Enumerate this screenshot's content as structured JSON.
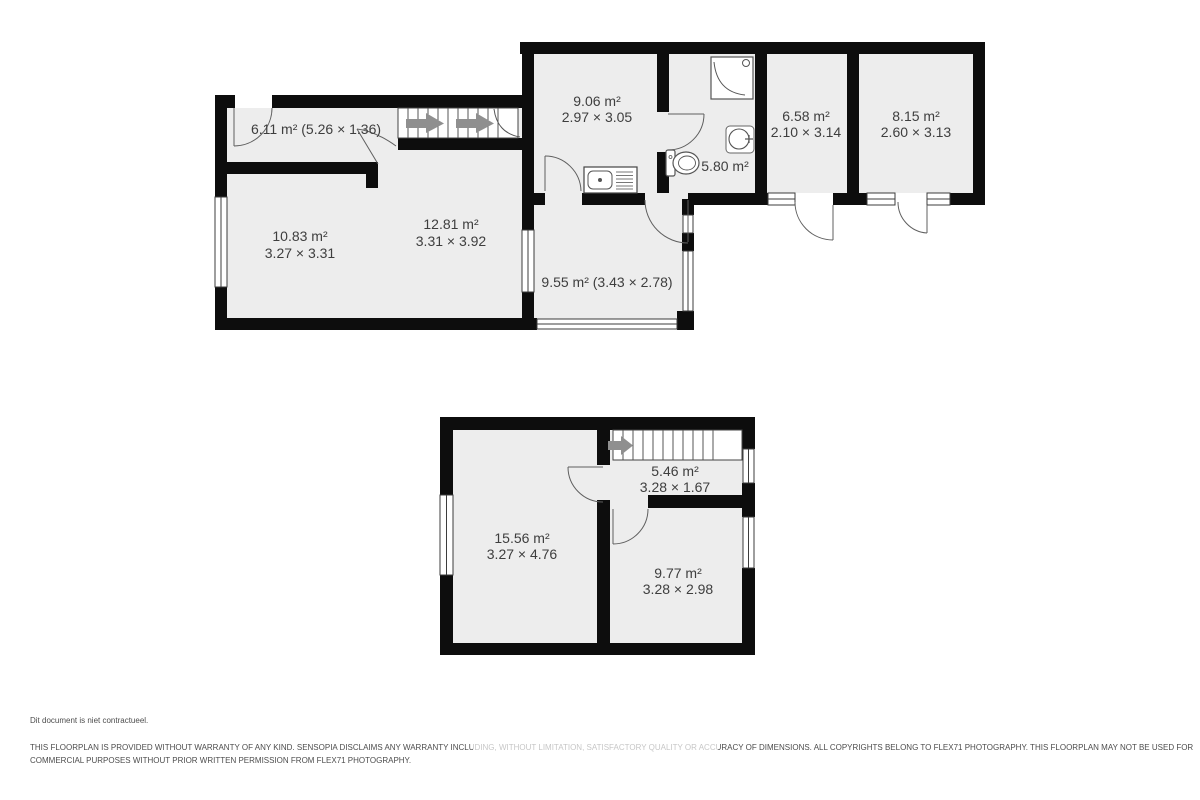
{
  "document_type": "floorplan",
  "colors": {
    "wall": "#0d0d0d",
    "room_fill": "#ededed",
    "stairs_fill": "#ffffff",
    "label_text": "#3e3e3e",
    "stair_arrow": "#8f8f8f",
    "door_arc": "#5f5f5f",
    "footer_text": "#4d4d4d",
    "page_background": "#ffffff"
  },
  "ground_floor": {
    "hall": {
      "area": "6.11 m² (5.26 × 1.36)"
    },
    "kitchen": {
      "area": "9.06 m²",
      "dims": "2.97 × 3.05"
    },
    "bathroom": {
      "area": "5.80 m²"
    },
    "bedroom_1": {
      "area": "6.58 m²",
      "dims": "2.10 × 3.14"
    },
    "bedroom_2": {
      "area": "8.15 m²",
      "dims": "2.60 × 3.13"
    },
    "sitting_room": {
      "area": "10.83 m²",
      "dims": "3.27 × 3.31"
    },
    "living_room": {
      "area": "12.81 m²",
      "dims": "3.31 × 3.92"
    },
    "conservatory": {
      "area": "9.55 m² (3.43 × 2.78)"
    }
  },
  "first_floor": {
    "landing": {
      "area": "5.46 m²",
      "dims": "3.28 × 1.67"
    },
    "bedroom_3": {
      "area": "15.56 m²",
      "dims": "3.27 × 4.76"
    },
    "bedroom_4": {
      "area": "9.77 m²",
      "dims": "3.28 × 2.98"
    }
  },
  "footer": {
    "note": "Dit document is niet contractueel.",
    "disclaimer_lines": [
      "THIS FLOORPLAN IS PROVIDED WITHOUT WARRANTY OF ANY KIND. SENSOPIA DISCLAIMS ANY WARRANTY INCLUDING, WITHOUT LIMITATION, SATISFACTORY QUALITY OR ACCURACY OF DIMENSIONS. ALL COPYRIGHTS BELONG TO FLEX71 PHOTOGRAPHY. THIS FLOORPLAN MAY NOT BE USED FOR",
      "COMMERCIAL PURPOSES WITHOUT PRIOR WRITTEN PERMISSION FROM FLEX71 PHOTOGRAPHY."
    ]
  }
}
